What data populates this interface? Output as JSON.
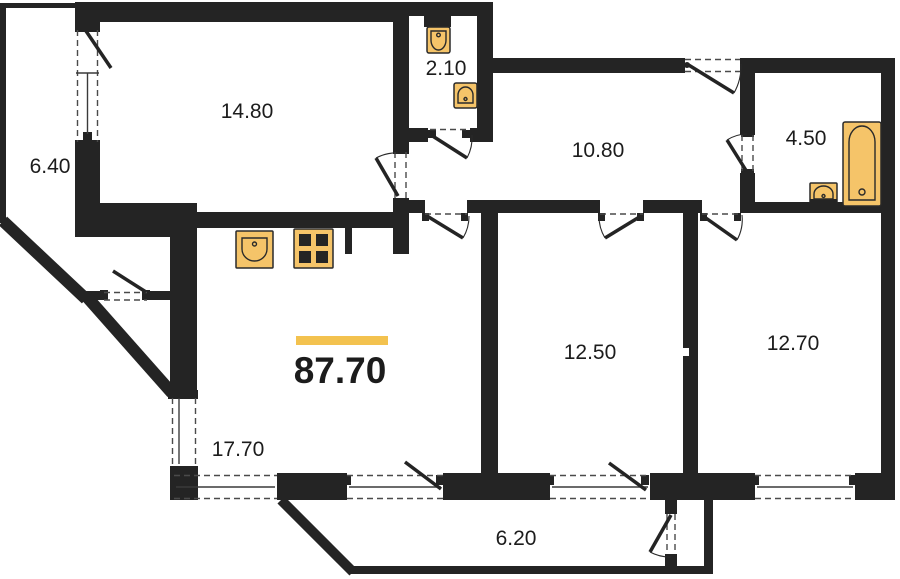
{
  "plan": {
    "title": "apartment-floor-plan",
    "total_area": {
      "value": "87.70"
    },
    "rooms": [
      {
        "id": "balcony-left",
        "area": "6.40"
      },
      {
        "id": "room-top-left",
        "area": "14.80"
      },
      {
        "id": "wc",
        "area": "2.10"
      },
      {
        "id": "hallway",
        "area": "10.80"
      },
      {
        "id": "bathroom",
        "area": "4.50"
      },
      {
        "id": "bedroom-1",
        "area": "12.50"
      },
      {
        "id": "bedroom-2",
        "area": "12.70"
      },
      {
        "id": "living-room",
        "area": "17.70"
      },
      {
        "id": "balcony-bottom",
        "area": "6.20"
      }
    ],
    "fixtures": [
      "toilet",
      "wc-sink",
      "bathroom-sink",
      "bathtub",
      "kitchen-sink",
      "stove"
    ],
    "colors": {
      "wall": "#242424",
      "fixture_fill": "#F5C469",
      "fixture_stroke": "#2A2A2A",
      "accent_bar": "#F3C24F",
      "background": "#FFFFFF"
    }
  }
}
